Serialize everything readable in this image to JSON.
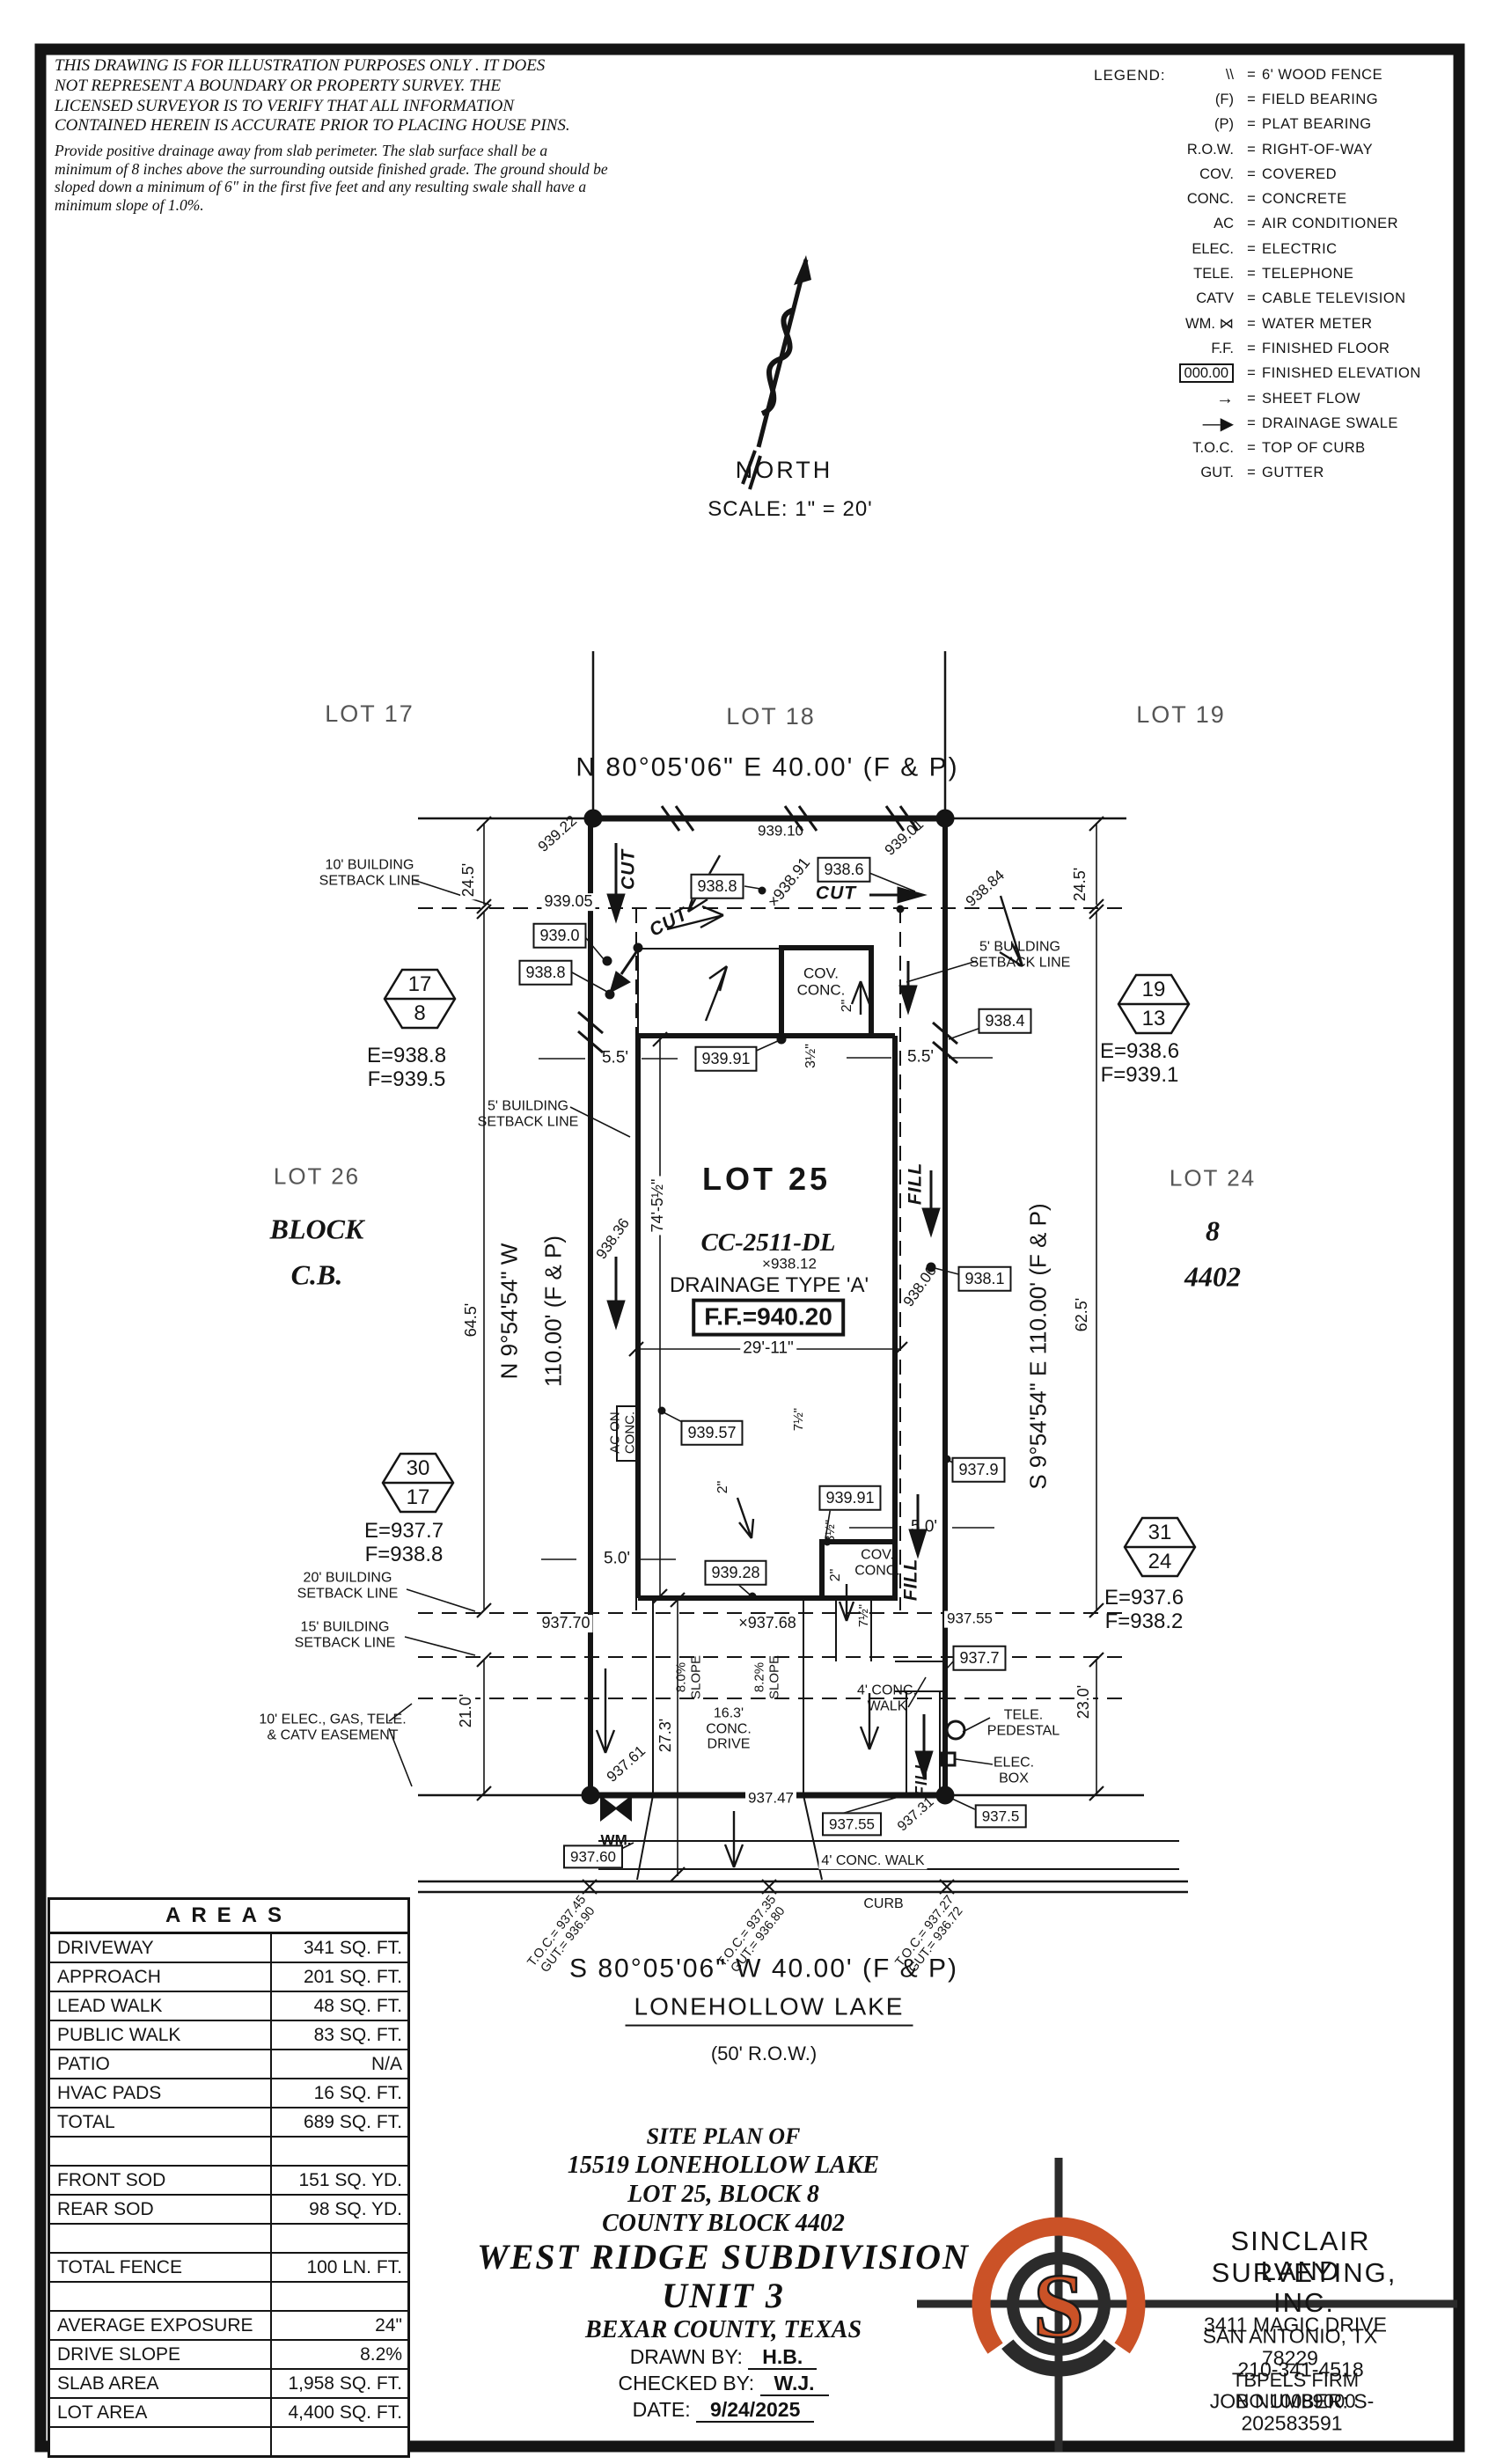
{
  "disclaimer": {
    "para1": "THIS DRAWING IS FOR ILLUSTRATION PURPOSES ONLY . IT DOES\nNOT REPRESENT A BOUNDARY OR PROPERTY SURVEY. THE\nLICENSED SURVEYOR IS TO VERIFY THAT ALL INFORMATION\nCONTAINED HEREIN IS ACCURATE PRIOR TO PLACING HOUSE PINS.",
    "para2": "Provide positive drainage away from slab perimeter. The slab surface shall be a\nminimum of 8 inches above the surrounding outside finished grade. The ground should be\nsloped down a minimum of 6\" in the first five feet and any resulting swale shall have a\nminimum slope of 1.0%."
  },
  "legend": {
    "title": "LEGEND:",
    "eq": "=",
    "items": [
      {
        "sym": "\\\\",
        "label": "6' WOOD FENCE"
      },
      {
        "sym": "(F)",
        "label": "FIELD BEARING"
      },
      {
        "sym": "(P)",
        "label": "PLAT BEARING"
      },
      {
        "sym": "R.O.W.",
        "label": "RIGHT-OF-WAY"
      },
      {
        "sym": "COV.",
        "label": "COVERED"
      },
      {
        "sym": "CONC.",
        "label": "CONCRETE"
      },
      {
        "sym": "AC",
        "label": "AIR CONDITIONER"
      },
      {
        "sym": "ELEC.",
        "label": "ELECTRIC"
      },
      {
        "sym": "TELE.",
        "label": "TELEPHONE"
      },
      {
        "sym": "CATV",
        "label": "CABLE TELEVISION"
      },
      {
        "sym": "WM. ⋈",
        "label": "WATER METER"
      },
      {
        "sym": "F.F.",
        "label": "FINISHED FLOOR"
      },
      {
        "sym": "000.00",
        "label": "FINISHED ELEVATION",
        "cls": "row-boxed"
      },
      {
        "sym": "→",
        "label": "SHEET FLOW",
        "cls": "row-arrow"
      },
      {
        "sym": "—▶",
        "label": "DRAINAGE SWALE",
        "cls": "row-arrow"
      },
      {
        "sym": "T.O.C.",
        "label": "TOP OF CURB"
      },
      {
        "sym": "GUT.",
        "label": "GUTTER"
      }
    ]
  },
  "north": {
    "label": "NORTH",
    "scale": "SCALE:  1\" = 20'"
  },
  "plan": {
    "labels": {
      "lot17": "LOT 17",
      "lot18": "LOT 18",
      "lot19": "LOT 19",
      "lot26": "LOT 26",
      "block_word": "BLOCK",
      "cb": "C.B.",
      "lot24": "LOT 24",
      "blk8": "8",
      "cb4402": "4402",
      "lot25": "LOT 25",
      "bearing_top": "N 80°05'06\" E 40.00' (F & P)",
      "bearing_bottom": "S 80°05'06\" W 40.00' (F & P)",
      "bearing_left1": "N 9°54'54\" W",
      "bearing_left2": "110.00' (F & P)",
      "bearing_right": "S 9°54'54\" E 110.00' (F & P)",
      "street_name": "LONEHOLLOW LAKE",
      "street_row": "(50' R.O.W.)",
      "cc": "CC-2511-DL",
      "pad_elev": "×938.12",
      "drainage": "DRAINAGE TYPE 'A'",
      "ff": "F.F.=940.20",
      "cut": "CUT",
      "fill": "FILL",
      "covconc": "COV.\nCONC.",
      "ac_pad": "AC ON\nCONC.",
      "setback10": "10' BUILDING\nSETBACK LINE",
      "setback5": "5' BUILDING\nSETBACK LINE",
      "setback20": "20' BUILDING\nSETBACK LINE",
      "setback15": "15' BUILDING\nSETBACK LINE",
      "easement": "10' ELEC., GAS, TELE.\n& CATV EASEMENT",
      "walk4a": "4' CONC.\nWALK",
      "walk4b": "4' CONC. WALK",
      "curb": "CURB",
      "drive163": "16.3'\nCONC.\nDRIVE",
      "slope80": "8.0%\nSLOPE",
      "slope82": "8.2%\nSLOPE",
      "tele_ped": "TELE.\nPEDESTAL",
      "elec_box": "ELEC.\nBOX",
      "wm": "WM.",
      "dim245": "24.5'",
      "dim64": "64.5'",
      "dim62": "62.5'",
      "dim21": "21.0'",
      "dim23": "23.0'",
      "dim55": "5.5'",
      "dim50": "5.0'",
      "dim74": "74'-5½\"",
      "dim29": "29'-11\"",
      "dim27": "27.3'",
      "inch2": "2\"",
      "inch35": "3½\"",
      "inch75": "7½\"",
      "e93922": "939.22",
      "e93910": "939.10",
      "e93901": "939.01",
      "e93905": "939.05",
      "b9390": "939.0",
      "b9388": "938.8",
      "x93891": "×938.91",
      "b9386": "938.6",
      "e93884": "938.84",
      "b9384": "938.4",
      "b93991": "939.91",
      "e93836": "938.36",
      "e93806": "938.06",
      "b9381": "938.1",
      "b93957": "939.57",
      "b9379": "937.9",
      "b93928": "939.28",
      "e93770": "937.70",
      "x93768": "×937.68",
      "e93755r": "937.55",
      "b9377": "937.7",
      "e93761": "937.61",
      "e93747": "937.47",
      "b93755": "937.55",
      "b9375": "937.5",
      "e93731": "937.31",
      "b93760": "937.60",
      "hex1_top": "17",
      "hex1_bot": "8",
      "hex2_top": "19",
      "hex2_bot": "13",
      "hex3_top": "30",
      "hex3_bot": "17",
      "hex4_top": "31",
      "hex4_bot": "24",
      "ef1a": "E=938.8",
      "ef1b": "F=939.5",
      "ef2a": "E=938.6",
      "ef2b": "F=939.1",
      "ef3a": "E=937.7",
      "ef3b": "F=938.8",
      "ef4a": "E=937.6",
      "ef4b": "F=938.2",
      "toc1": "T.O.C.= 937.45\nGUT.= 936.90",
      "toc2": "T.O.C.= 937.35\nGUT.= 936.80",
      "toc3": "T.O.C.= 937.27\nGUT.= 936.72"
    }
  },
  "areas": {
    "title": "AREAS",
    "rows": [
      {
        "label": "DRIVEWAY",
        "value": "341 SQ. FT."
      },
      {
        "label": "APPROACH",
        "value": "201 SQ. FT."
      },
      {
        "label": "LEAD WALK",
        "value": "48 SQ. FT."
      },
      {
        "label": "PUBLIC WALK",
        "value": "83 SQ. FT."
      },
      {
        "label": "PATIO",
        "value": "N/A"
      },
      {
        "label": "HVAC PADS",
        "value": "16 SQ. FT."
      },
      {
        "label": "TOTAL",
        "value": "689 SQ. FT."
      },
      {
        "label": "",
        "value": ""
      },
      {
        "label": "FRONT SOD",
        "value": "151 SQ. YD."
      },
      {
        "label": "REAR SOD",
        "value": "98 SQ. YD."
      },
      {
        "label": "",
        "value": ""
      },
      {
        "label": "TOTAL FENCE",
        "value": "100 LN. FT."
      },
      {
        "label": "",
        "value": ""
      },
      {
        "label": "AVERAGE EXPOSURE",
        "value": "24\""
      },
      {
        "label": "DRIVE SLOPE",
        "value": "8.2%"
      },
      {
        "label": "SLAB AREA",
        "value": "1,958 SQ. FT."
      },
      {
        "label": "LOT AREA",
        "value": "4,400 SQ. FT."
      },
      {
        "label": "",
        "value": ""
      }
    ]
  },
  "title_block": {
    "line1": "SITE PLAN OF",
    "line2": "15519 LONEHOLLOW LAKE",
    "line3": "LOT 25, BLOCK 8",
    "line4": "COUNTY BLOCK 4402",
    "line5": "WEST RIDGE SUBDIVISION",
    "line6": "UNIT 3",
    "line7": "BEXAR COUNTY, TEXAS",
    "drawn_label": "DRAWN BY:",
    "drawn": "H.B.",
    "checked_label": "CHECKED BY:",
    "checked": "W.J.",
    "date_label": "DATE:",
    "date": "9/24/2025"
  },
  "surveyor": {
    "logo_letter": "S",
    "accent": "#CB5227",
    "name1": "SINCLAIR LAND",
    "name2": "SURVEYING, INC.",
    "addr1": "3411 MAGIC DRIVE",
    "addr2": "SAN ANTONIO, TX 78229",
    "phone": "210-341-4518",
    "firm": "TBPELS FIRM NO.10089000",
    "job": "JOB NUMBER: S-202583591"
  }
}
